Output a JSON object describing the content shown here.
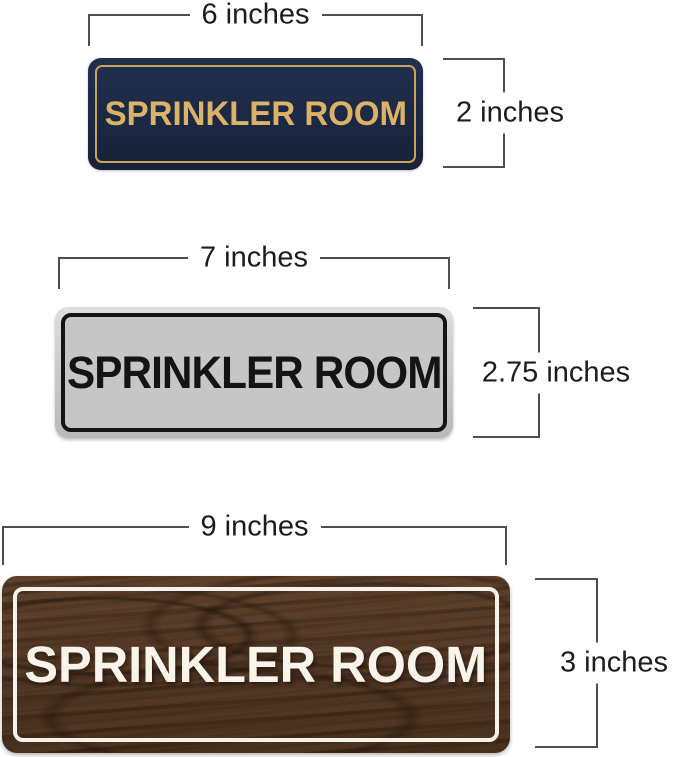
{
  "image": {
    "background_color": "#ffffff",
    "dimension_line_color": "#4e4e4e",
    "dimension_text_color": "#1c1c1c"
  },
  "signs": [
    {
      "name": "navy-gold-sign",
      "label": "SPRINKLER ROOM",
      "width_label": "6 inches",
      "height_label": "2 inches",
      "bg_color": "#1c2944",
      "text_color": "#dcb267",
      "border_color": "#c9a35c"
    },
    {
      "name": "silver-black-sign",
      "label": "SPRINKLER ROOM",
      "width_label": "7 inches",
      "height_label": "2.75 inches",
      "bg_color": "#c6c6c6",
      "text_color": "#141414",
      "border_color": "#151515"
    },
    {
      "name": "walnut-white-sign",
      "label": "SPRINKLER ROOM",
      "width_label": "9 inches",
      "height_label": "3 inches",
      "bg_color": "#503624",
      "text_color": "#f8f4ec",
      "border_color": "#f6f2e9"
    }
  ]
}
